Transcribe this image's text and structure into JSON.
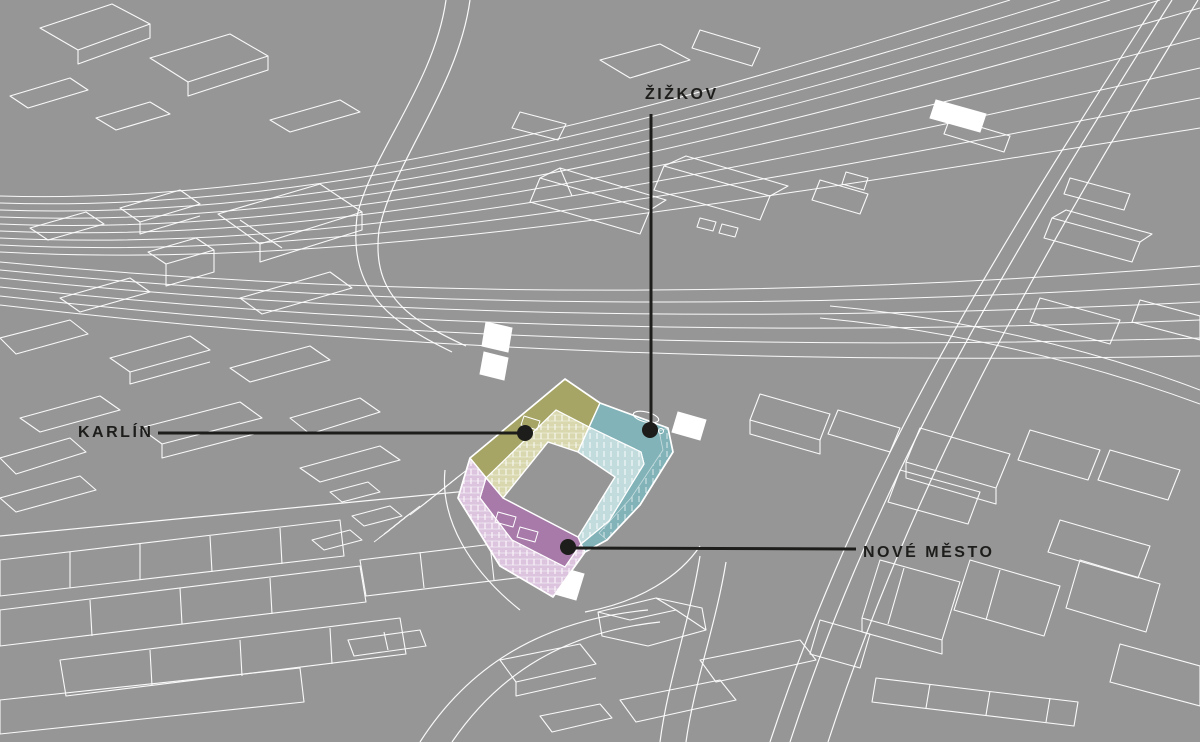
{
  "map": {
    "title": "Axonometric site map of Prague districts around a courtyard building project",
    "labels": {
      "zizkov": {
        "text": "ŽIŽKOV"
      },
      "karlin": {
        "text": "KARLÍN"
      },
      "nove_mesto": {
        "text": "NOVÉ MĚSTO"
      }
    }
  },
  "colors": {
    "background": "#969696",
    "linework": "#ffffff",
    "label_text": "#1d1d1b",
    "leader_line": "#1d1d1b",
    "karlin_wing": "#a6a566",
    "karlin_wing_facade": "#d8d7ae",
    "zizkov_wing": "#82b3b8",
    "zizkov_wing_facade": "#c2dcde",
    "nove_mesto_wing": "#a87aaa",
    "nove_mesto_wing_facade": "#ddc4de",
    "courtyard": "#969696"
  }
}
